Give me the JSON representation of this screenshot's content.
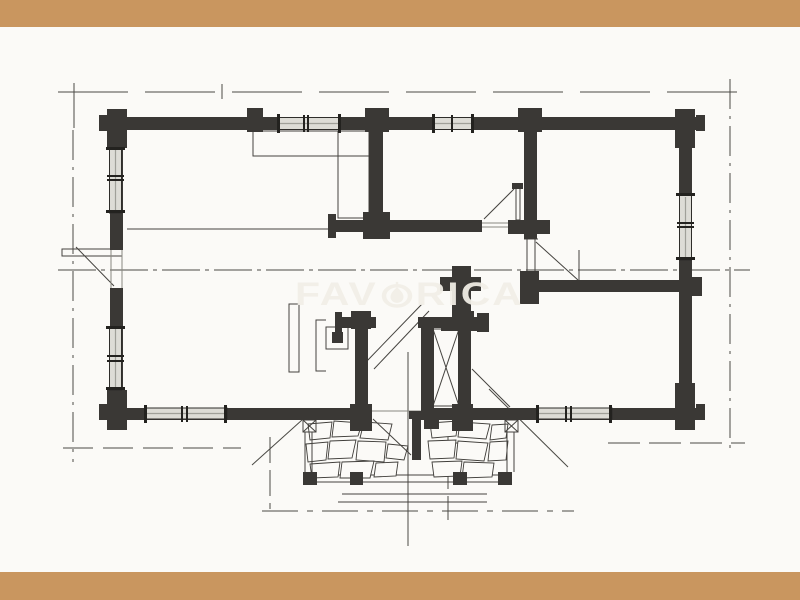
{
  "watermark": {
    "text": "FAVORICA",
    "left": "FAV",
    "right": "RICA"
  },
  "colors": {
    "band": "#c9965f",
    "paper": "#fbfaf7",
    "wall": "#3a3835",
    "line": "#4b4a45",
    "winfill": "#dddcd6",
    "wm": "#f2efe7"
  }
}
